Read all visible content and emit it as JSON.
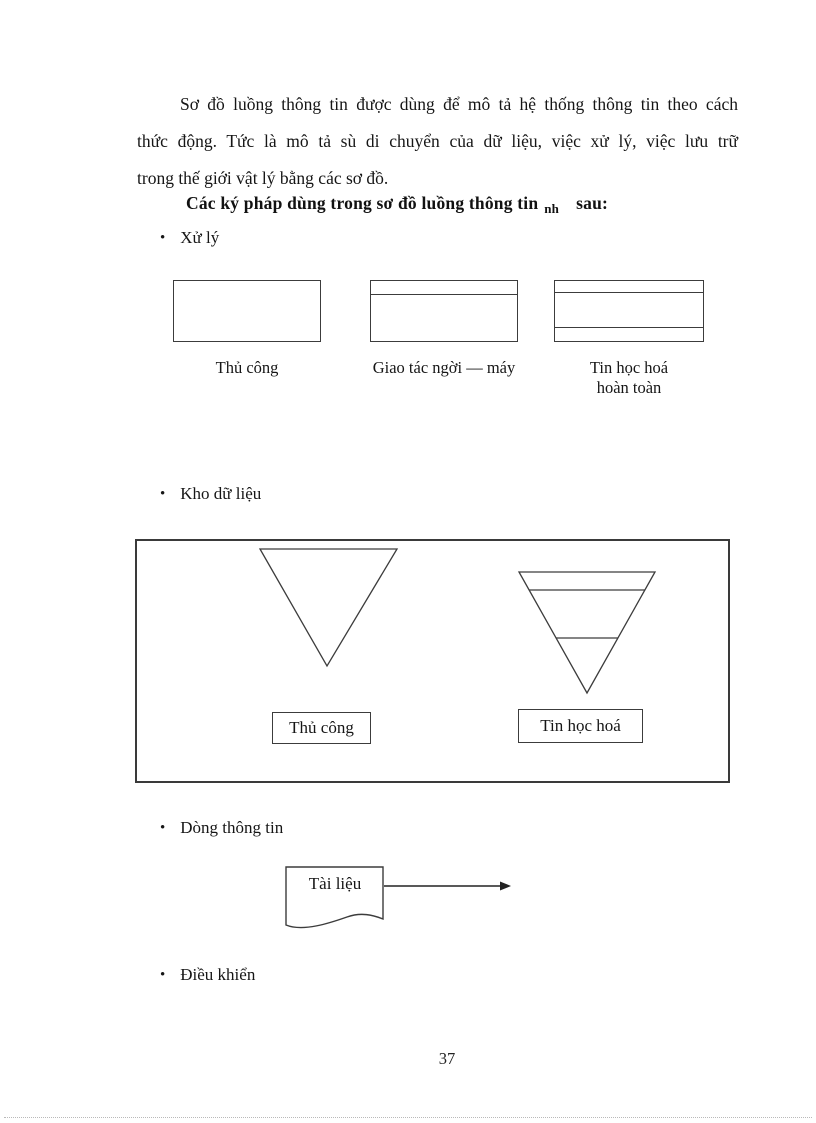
{
  "paragraph": {
    "lines": [
      "Sơ đồ luồng thông tin được dùng để mô tả hệ thống thông tin theo cách",
      "thức động. Tức là mô tả sù di chuyển của dữ liệu, việc xử lý, việc lưu trữ",
      "trong thế giới vật lý bằng các sơ đồ."
    ]
  },
  "heading": {
    "main": "Các ký pháp dùng trong sơ đồ luồng thông tin",
    "subscript": "nh",
    "tail": "sau:"
  },
  "bullets": {
    "dot": "•",
    "processing": "Xử lý",
    "datastore": "Kho dữ liệu",
    "flow": "Dòng thông tin",
    "control": "Điều khiển"
  },
  "processing_symbols": {
    "manual": {
      "label": "Thủ công",
      "type": "plain-rectangle"
    },
    "interactive": {
      "label": "Giao tác ngời  — máy",
      "type": "rectangle-top-stripe"
    },
    "computerized": {
      "label_line1": "Tin học hoá",
      "label_line2": "hoàn toàn",
      "type": "rectangle-top-bottom-stripe"
    }
  },
  "datastore_symbols": {
    "manual_label": "Thủ công",
    "computerized_label": "Tin học hoá"
  },
  "flow_symbol": {
    "label": "Tài liệu"
  },
  "footer": {
    "page_number": "37"
  },
  "colors": {
    "ink": "#1c1c1c",
    "shape_stroke": "#3c3c3c",
    "background": "#ffffff"
  }
}
